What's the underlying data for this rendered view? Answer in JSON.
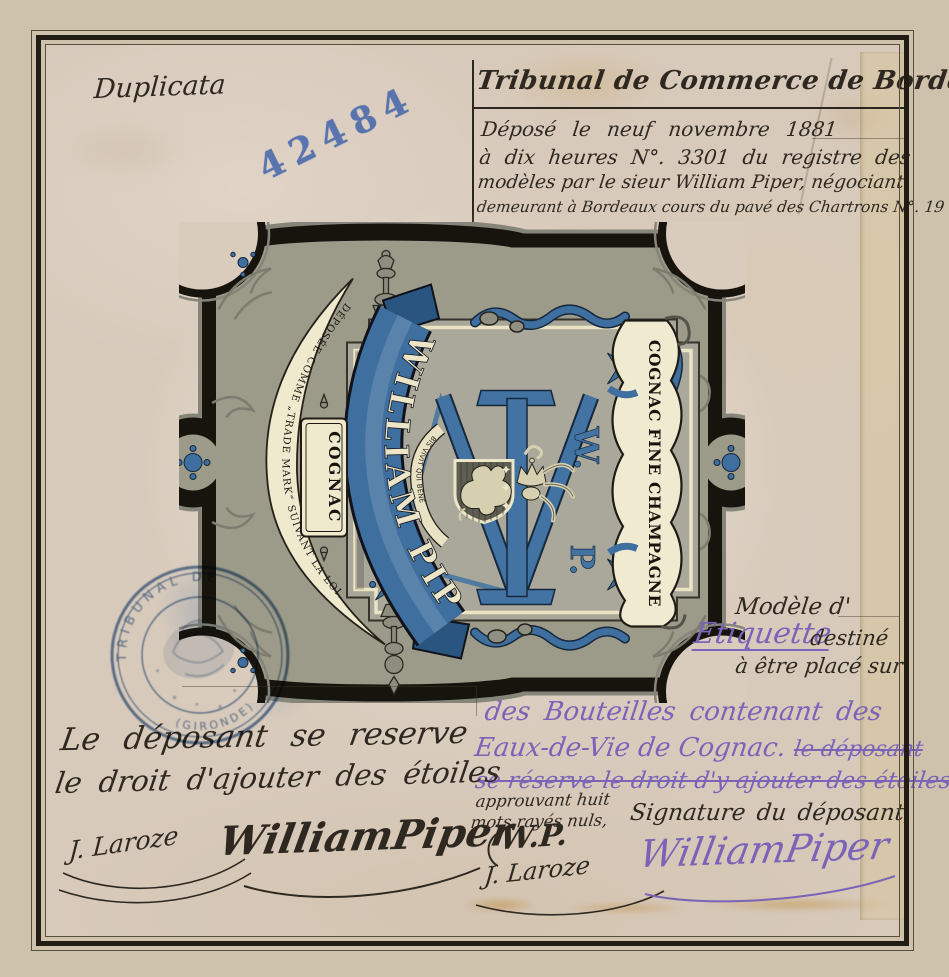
{
  "page": {
    "duplicata": "Duplicata",
    "registry_stamp": "42484"
  },
  "header": {
    "title": "Tribunal de Commerce de Bordeaux",
    "deposit_lines": [
      "Déposé le neuf novembre 1881",
      "à dix heures N°. 3301 du registre des",
      "modèles par le sieur William Piper, négociant",
      "demeurant à Bordeaux cours du pavé des Chartrons N°. 19"
    ]
  },
  "label_art": {
    "deposee_banner": "DÉPOSÉE COMME „TRADE MARK“ SUIVANT LA LOI.",
    "name_ribbon": "WILLIAM PIPER",
    "cognac_cartouche": "COGNAC",
    "right_cartouche": "COGNAC FINE CHAMPAGNE",
    "motto": "BIS VIVIT QUI BENE",
    "monogram": {
      "w": "W.",
      "p": "P."
    }
  },
  "stamp_round": {
    "arc_top": "TRIBUNAL DE",
    "arc_bottom": "(GIRONDE)"
  },
  "model_note": {
    "prefix": "Modèle d'",
    "etiquette": "Etiquette",
    "destine": "destiné",
    "line2": "à être placé sur"
  },
  "subject_note": {
    "line1": "des Bouteilles contenant des",
    "line2": "Eaux-de-Vie de Cognac.",
    "line2_struck": "le déposant",
    "line3_struck": "se réserve le droit d'y ajouter des étoiles"
  },
  "approval_note": {
    "line1": "approuvant huit",
    "line2": "mots rayés nuls,"
  },
  "signature_section": {
    "caption": "Signature du déposant,",
    "reserve_line1": "Le déposant se reserve",
    "reserve_line2": "le droit d'ajouter des étoiles",
    "clerk_signature": "J. Laroze",
    "depositor_signature_black": "WilliamPiper",
    "initials": "W.P.",
    "clerk_signature2": "J. Laroze",
    "depositor_signature_purple": "WilliamPiper"
  }
}
